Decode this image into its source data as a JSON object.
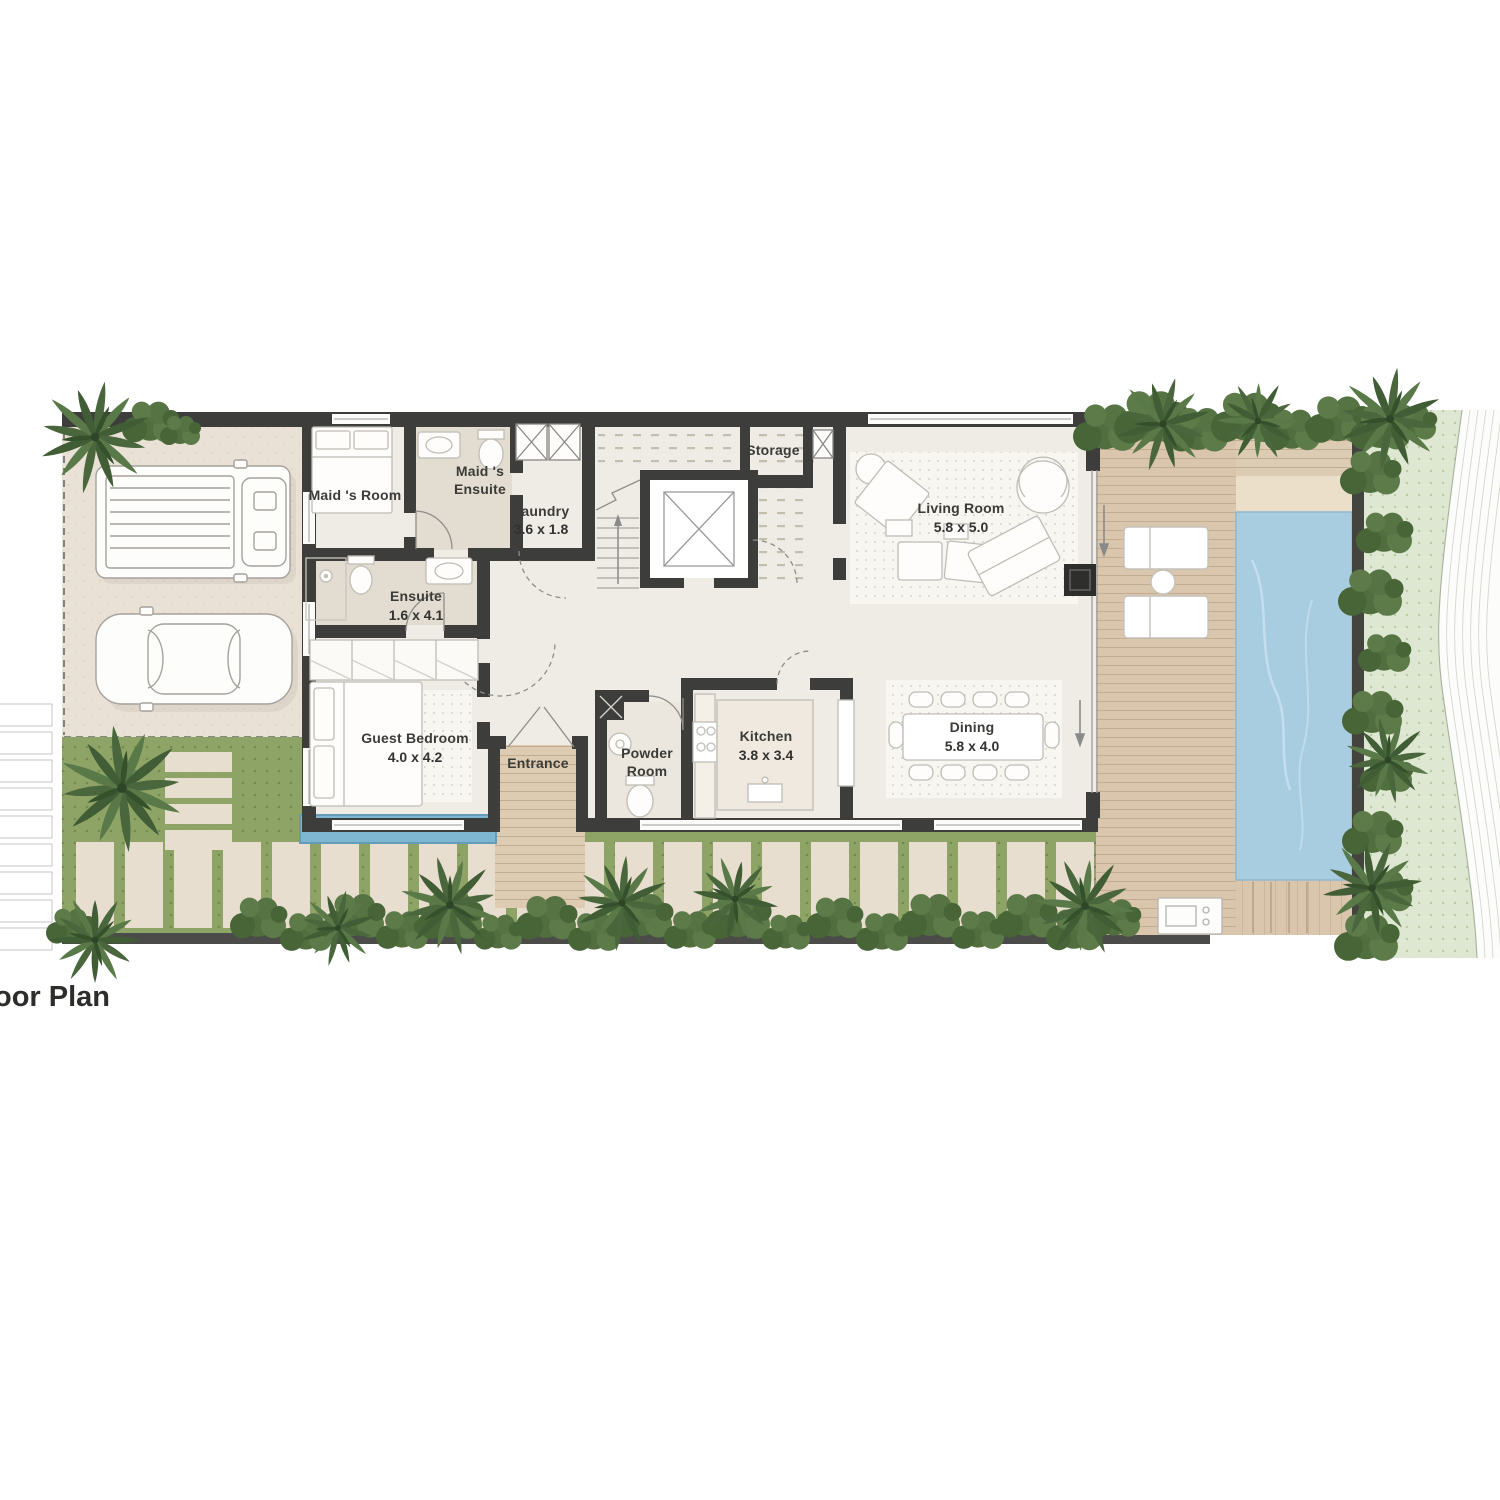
{
  "title": "oor Plan",
  "rooms": {
    "maids_room": {
      "name": "Maid 's Room"
    },
    "maids_ensuite": {
      "line1": "Maid 's",
      "line2": "Ensuite"
    },
    "laundry": {
      "name": "Laundry",
      "dims": "3.6 x 1.8"
    },
    "storage": {
      "name": "Storage"
    },
    "living_room": {
      "name": "Living Room",
      "dims": "5.8 x 5.0"
    },
    "ensuite": {
      "name": "Ensuite",
      "dims": "1.6 x 4.1"
    },
    "guest_bedroom": {
      "name": "Guest Bedroom",
      "dims": "4.0 x 4.2"
    },
    "entrance": {
      "name": "Entrance"
    },
    "powder_room": {
      "line1": "Powder",
      "line2": "Room"
    },
    "kitchen": {
      "name": "Kitchen",
      "dims": "3.8 x 3.4"
    },
    "dining": {
      "name": "Dining",
      "dims": "5.8 x 4.0"
    }
  },
  "colors": {
    "wall": "#3d3d3b",
    "floor": "#efece6",
    "bath_floor": "#e3ddd1",
    "driveway": "#e9e1d5",
    "deck": "#d9c6ad",
    "pool": "#a9cde0",
    "plunge_pool": "#7fb7d2",
    "lawn": "#8ea467",
    "lawn_light": "#dde7d1",
    "hedge": "#516f3e",
    "terrain": "#fcfcfb"
  }
}
